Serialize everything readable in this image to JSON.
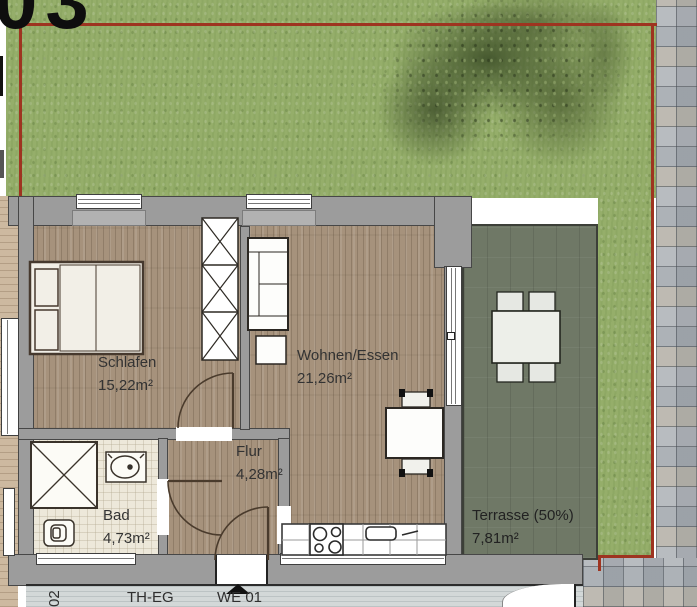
{
  "title": "Ground floor apartment plan WE 01",
  "plot_label_partial": "03",
  "rooms": {
    "schlafen": {
      "name": "Schlafen",
      "area": "15,22m²"
    },
    "wohnen": {
      "name": "Wohnen/Essen",
      "area": "21,26m²"
    },
    "bad": {
      "name": "Bad",
      "area": "4,73m²"
    },
    "flur": {
      "name": "Flur",
      "area": "4,28m²"
    },
    "terrasse": {
      "name": "Terrasse (50%)",
      "area": "7,81m²"
    }
  },
  "labels": {
    "stairwell": "TH-EG",
    "unit_entrance": "WE 01",
    "adjacent_unit_partial": "02"
  },
  "colors": {
    "boundary_red": "#9e3420",
    "grass_green": "#95ae6a",
    "wall_grey": "#9c9c9c",
    "wood_floor": "#a6927c",
    "terrace_grey_green": "#6f7866",
    "bath_cream": "#ede8da",
    "paver_grey": "#aeb2b6"
  }
}
